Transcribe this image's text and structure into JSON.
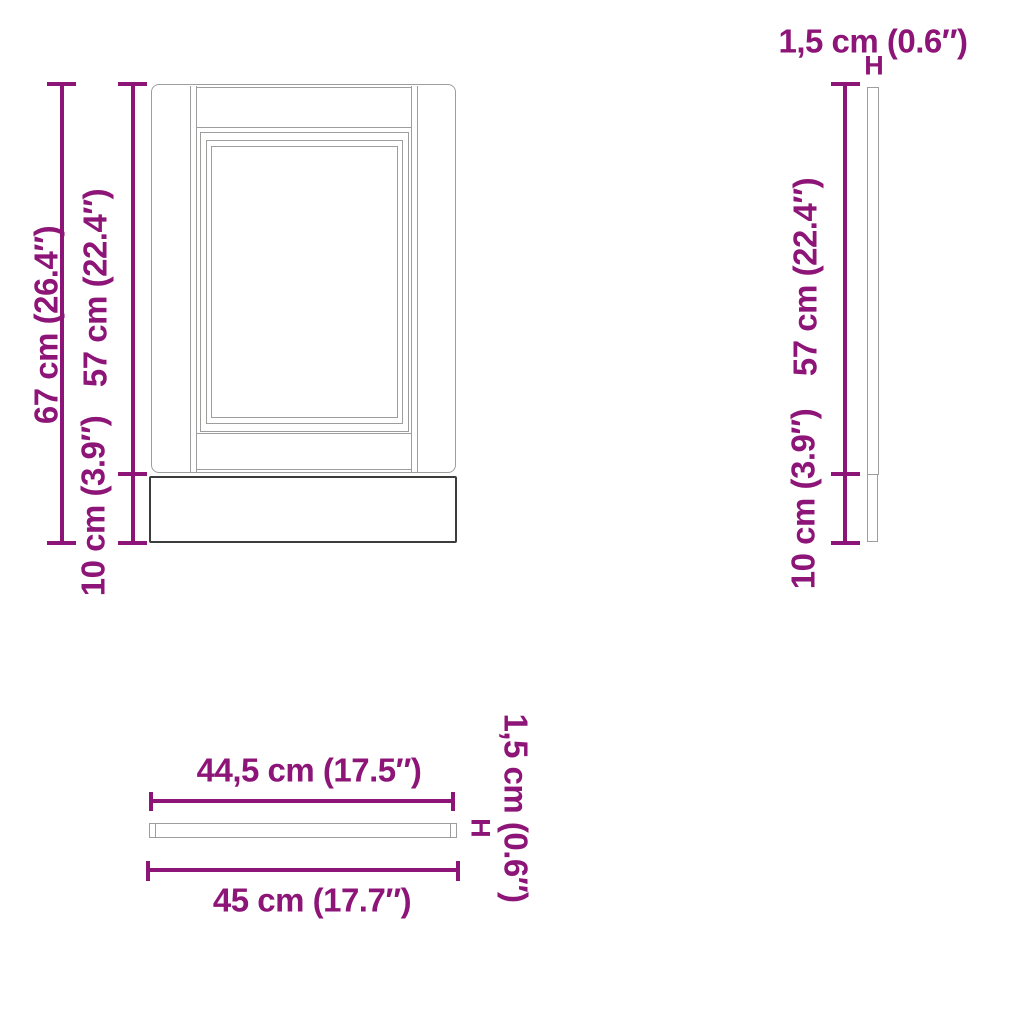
{
  "colors": {
    "dimension": "#8E1578",
    "outline_light": "#9D9D9C",
    "outline_dark": "#3C3C3B",
    "background": "#FFFFFF"
  },
  "markers": {
    "thickness_bracket": "H"
  },
  "views": {
    "front": {
      "total_height": "67 cm (26.4″)",
      "door_height": "57 cm (22.4″)",
      "plinth_height": "10 cm (3.9″)"
    },
    "side": {
      "thickness": "1,5 cm (0.6″)",
      "door_height": "57 cm (22.4″)",
      "plinth_height": "10 cm (3.9″)"
    },
    "top": {
      "front_width": "44,5 cm (17.5″)",
      "total_width": "45 cm (17.7″)",
      "thickness": "1,5 cm (0.6″)"
    }
  }
}
